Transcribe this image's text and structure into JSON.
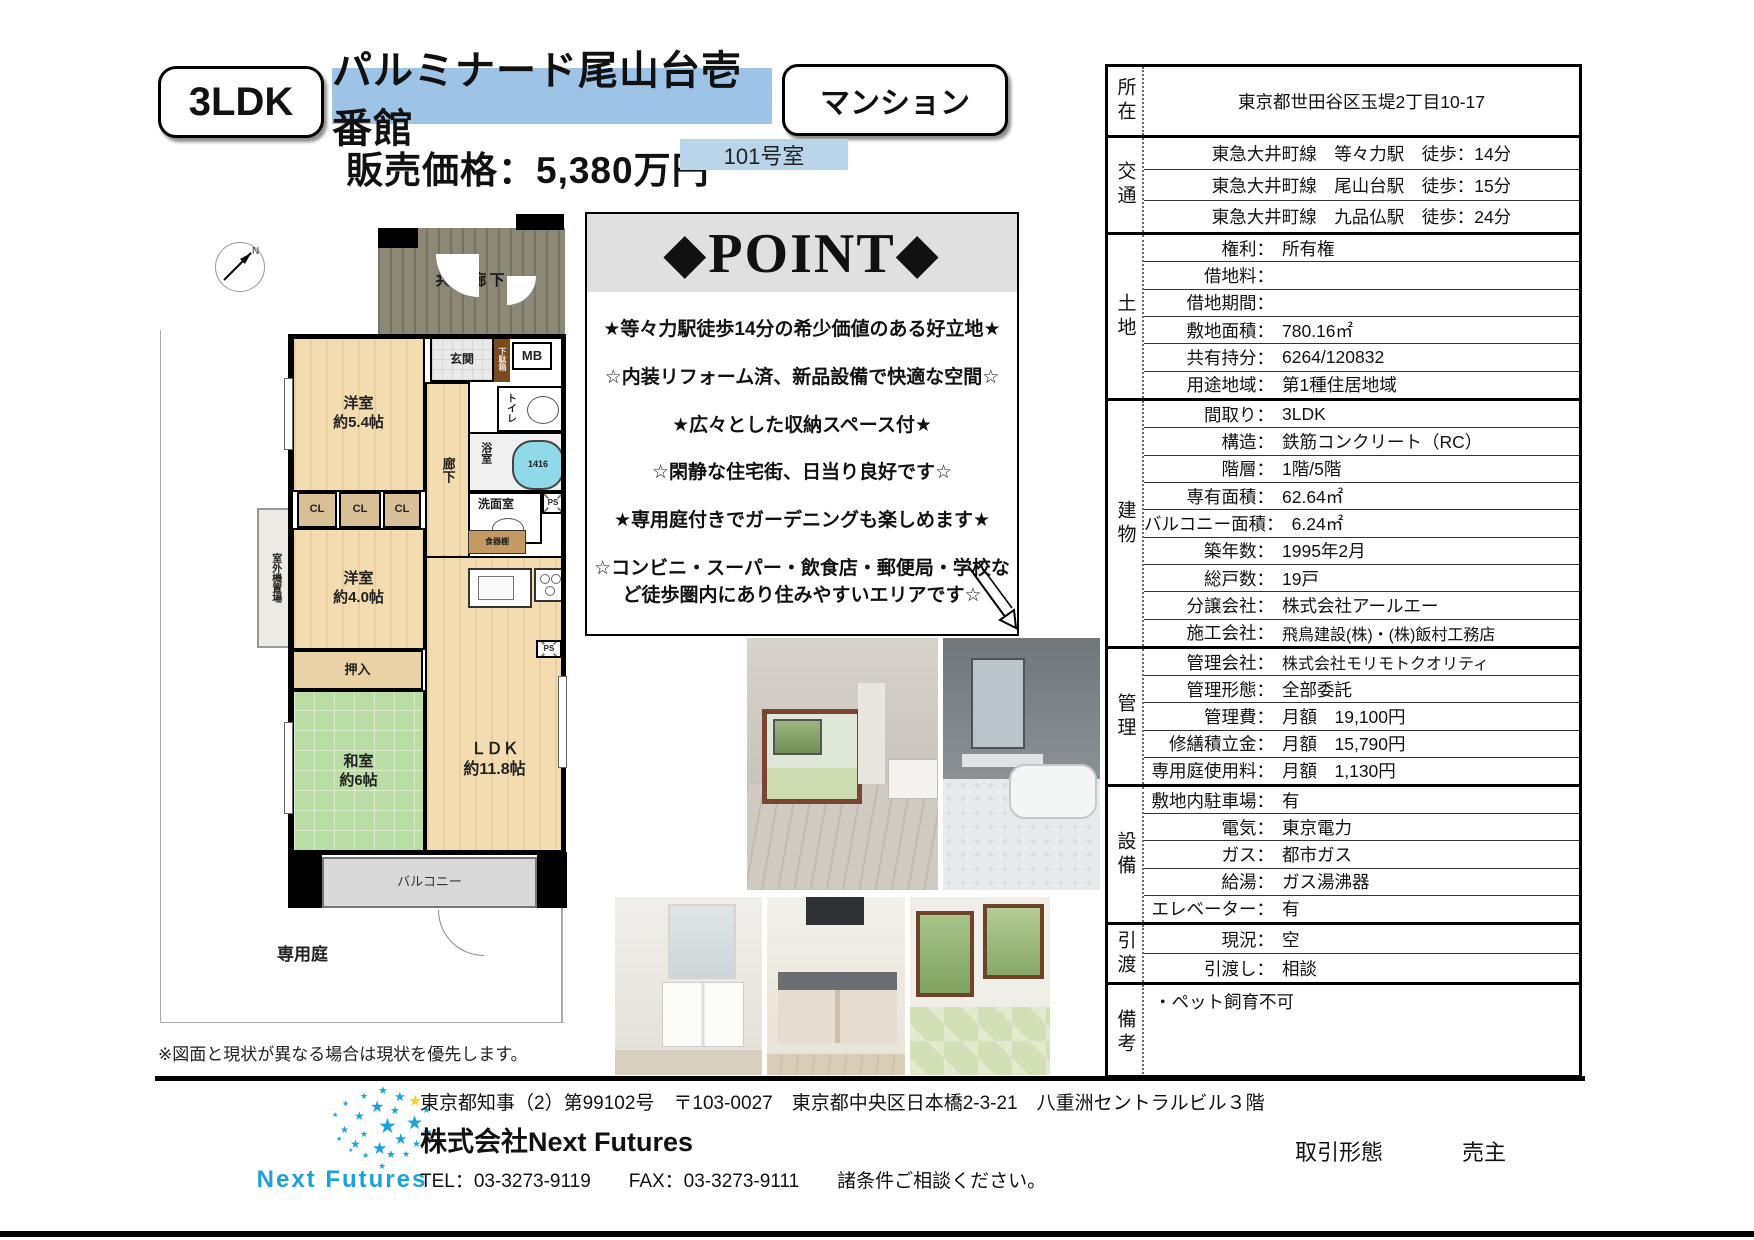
{
  "colors": {
    "accent_blue": "#9dc3e6",
    "room_blue": "#b9d5ea",
    "logo_cyan": "#1ba3d7",
    "star_yellow": "#f5d327"
  },
  "header": {
    "layout_badge": "3LDK",
    "building_name": "パルミナード尾山台壱番館",
    "type_badge": "マンション",
    "price": "販売価格：5,380万円",
    "room_no": "101号室"
  },
  "point": {
    "title": "◆POINT◆",
    "items": [
      "★等々力駅徒歩14分の希少価値のある好立地★",
      "☆内装リフォーム済、新品設備で快適な空間☆",
      "★広々とした収納スペース付★",
      "☆閑静な住宅街、日当り良好です☆",
      "★専用庭付きでガーデニングも楽しめます★",
      "☆コンビニ・スーパー・飲食店・郵便局・学校など徒歩圏内にあり住みやすいエリアです☆"
    ]
  },
  "table": {
    "groups": [
      {
        "label": "所在",
        "rows": [
          {
            "center": "東京都世田谷区玉堤2丁目10-17"
          }
        ]
      },
      {
        "label": "交通",
        "rows": [
          {
            "center": "東急大井町線　等々力駅　徒歩：14分"
          },
          {
            "center": "東急大井町線　尾山台駅　徒歩：15分"
          },
          {
            "center": "東急大井町線　九品仏駅　徒歩：24分"
          }
        ]
      },
      {
        "label": "土地",
        "rows": [
          {
            "label": "権利：",
            "value": "所有権"
          },
          {
            "label": "借地料：",
            "value": ""
          },
          {
            "label": "借地期間：",
            "value": ""
          },
          {
            "label": "敷地面積：",
            "value": "780.16㎡"
          },
          {
            "label": "共有持分：",
            "value": "6264/120832"
          },
          {
            "label": "用途地域：",
            "value": "第1種住居地域"
          }
        ]
      },
      {
        "label": "建物",
        "rows": [
          {
            "label": "間取り：",
            "value": "3LDK"
          },
          {
            "label": "構造：",
            "value": "鉄筋コンクリート（RC）"
          },
          {
            "label": "階層：",
            "value": "1階/5階"
          },
          {
            "label": "専有面積：",
            "value": "62.64㎡"
          },
          {
            "label": "バルコニー面積：",
            "value": "6.24㎡"
          },
          {
            "label": "築年数：",
            "value": "1995年2月"
          },
          {
            "label": "総戸数：",
            "value": "19戸"
          },
          {
            "label": "分譲会社：",
            "value": "株式会社アールエー"
          },
          {
            "label": "施工会社：",
            "value": "飛鳥建設(株)・(株)飯村工務店"
          }
        ]
      },
      {
        "label": "管理",
        "rows": [
          {
            "label": "管理会社：",
            "value": "株式会社モリモトクオリティ"
          },
          {
            "label": "管理形態：",
            "value": "全部委託"
          },
          {
            "label": "管理費：",
            "value": "月額　19,100円"
          },
          {
            "label": "修繕積立金：",
            "value": "月額　15,790円"
          },
          {
            "label": "専用庭使用料：",
            "value": "月額　1,130円"
          }
        ]
      },
      {
        "label": "設備",
        "rows": [
          {
            "label": "敷地内駐車場：",
            "value": "有"
          },
          {
            "label": "電気：",
            "value": "東京電力"
          },
          {
            "label": "ガス：",
            "value": "都市ガス"
          },
          {
            "label": "給湯：",
            "value": "ガス湯沸器"
          },
          {
            "label": "エレベーター：",
            "value": "有"
          }
        ]
      },
      {
        "label": "引渡",
        "rows": [
          {
            "label": "現況：",
            "value": "空"
          },
          {
            "label": "引渡し：",
            "value": "相談"
          }
        ]
      },
      {
        "label": "備考",
        "rows": [
          {
            "note": "・ペット飼育不可"
          }
        ]
      }
    ]
  },
  "floorplan": {
    "north": "N",
    "common_corridor": "共用廊下",
    "entrance": "玄関",
    "shoe_box": "下駄箱",
    "mb": "MB",
    "toilet": "トイレ",
    "bath": "浴室",
    "tub_size": "1416",
    "washroom": "洗面室",
    "ps1": "PS",
    "ps2": "PS",
    "hallway": "廊下",
    "bedroom1_name": "洋室",
    "bedroom1_size": "約5.4帖",
    "cl1": "CL",
    "cl2": "CL",
    "cl3": "CL",
    "outdoor_unit": "室外機置場",
    "bedroom2_name": "洋室",
    "bedroom2_size": "約4.0帖",
    "oshiire": "押入",
    "washitsu_name": "和室",
    "washitsu_size": "約6帖",
    "dish_shelf": "食器棚",
    "ldk_name": "ＬＤＫ",
    "ldk_size": "約11.8帖",
    "balcony": "バルコニー",
    "private_garden": "専用庭",
    "disclaimer": "※図面と現状が異なる場合は現状を優先します。"
  },
  "footer": {
    "license_line": "東京都知事（2）第99102号　〒103-0027　東京都中央区日本橋2-3-21　八重洲セントラルビル３階",
    "company": "株式会社Next Futures",
    "tel_line": "TEL：03-3273-9119　　FAX：03-3273-9111　　諸条件ご相談ください。",
    "logo_text": "Next Futures",
    "deal_type_label": "取引形態",
    "deal_type_value": "売主"
  }
}
